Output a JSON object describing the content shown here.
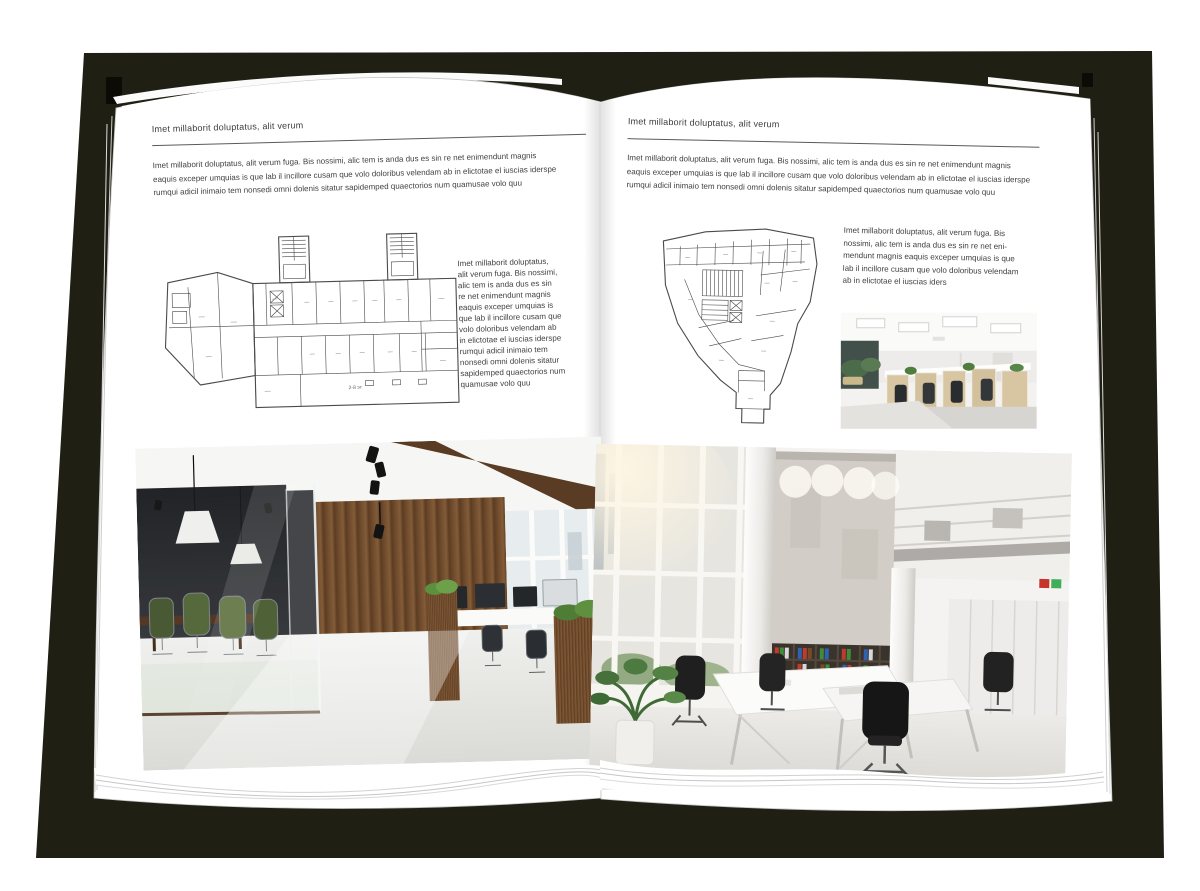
{
  "document": {
    "type": "open-magazine-spread-mockup",
    "backdrop_color": "#201f13",
    "page_color": "#ffffff",
    "text_color": "#3d3d3d"
  },
  "left_page": {
    "header": "Imet millaborit doluptatus, alit verum",
    "intro_lines": [
      "Imet millaborit doluptatus, alit verum fuga. Bis nossimi, alic tem is anda dus es sin re net enimendunt magnis",
      "eaquis exceper umquias is que lab il incillore cusam que volo doloribus velendam ab in elictotae el iuscias iderspe",
      "rumqui adicil inimaio tem nonsedi omni dolenis sitatur sapidemped quaectorios num quamusae volo quu"
    ],
    "floor_plan_name": "wide-building-floor-plan",
    "floor_plan_annotation": "2-й эт",
    "side_lines": [
      "Imet millaborit doluptatus,",
      "alit verum fuga. Bis nossimi,",
      "alic tem is anda dus es sin",
      "re net enimendunt magnis",
      "eaquis exceper umquias is",
      "que lab il incillore cusam que",
      "volo doloribus velendam ab",
      "in elictotae el iuscias iderspe",
      "rumqui adicil inimaio tem",
      "nonsedi omni dolenis sitatur",
      "sapidemped quaectorios num",
      "quamusae volo quu"
    ],
    "photo_name": "wood-loft-office-with-glass-meeting-room-photo"
  },
  "right_page": {
    "header": "Imet millaborit doluptatus, alit verum",
    "intro_lines": [
      "Imet millaborit doluptatus, alit verum fuga. Bis nossimi, alic tem is anda dus es sin re net enimendunt magnis",
      "eaquis exceper umquias is que lab il incillore cusam que volo doloribus velendam ab in elictotae el iuscias iderspe",
      "rumqui adicil inimaio tem nonsedi omni dolenis sitatur sapidemped quaectorios num quamusae volo quu"
    ],
    "floor_plan_name": "irregular-building-floor-plan",
    "side_lines": [
      "Imet millaborit doluptatus, alit verum fuga. Bis",
      "nossimi, alic tem is anda dus es sin re net eni-",
      "mendunt magnis eaquis exceper umquias is que",
      "lab il incillore cusam que volo doloribus velendam",
      "ab in elictotae el iuscias iders"
    ],
    "small_photo_name": "open-plan-office-cubicles-photo",
    "photo_name": "tall-white-office-atrium-photo"
  }
}
